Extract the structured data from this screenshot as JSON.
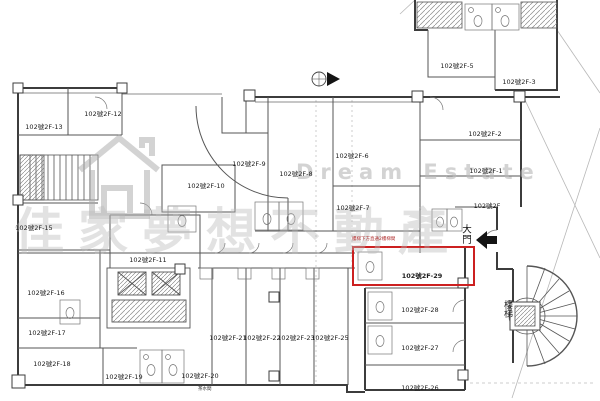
{
  "watermark": {
    "brand_en": "Dream Estate",
    "brand_zh": "佳家夢想不動產"
  },
  "annotations": {
    "entrance_label": "大門",
    "stair_label": "樓梯",
    "red_note": "樓梯下方直通2樓梯間",
    "pantry_label": "茶水間"
  },
  "highlight": {
    "room": "102號2F-29",
    "color": "#cc2020"
  },
  "rooms": [
    {
      "label": "102號2F-13",
      "x": 44,
      "y": 126
    },
    {
      "label": "102號2F-12",
      "x": 103,
      "y": 113
    },
    {
      "label": "102號2F-15",
      "x": 34,
      "y": 227
    },
    {
      "label": "102號2F-16",
      "x": 46,
      "y": 292
    },
    {
      "label": "102號2F-17",
      "x": 47,
      "y": 332
    },
    {
      "label": "102號2F-18",
      "x": 52,
      "y": 363
    },
    {
      "label": "102號2F-11",
      "x": 148,
      "y": 259
    },
    {
      "label": "102號2F-10",
      "x": 206,
      "y": 185
    },
    {
      "label": "102號2F-9",
      "x": 249,
      "y": 163
    },
    {
      "label": "102號2F-8",
      "x": 296,
      "y": 173
    },
    {
      "label": "102號2F-6",
      "x": 352,
      "y": 155
    },
    {
      "label": "102號2F-7",
      "x": 353,
      "y": 207
    },
    {
      "label": "102號2F-5",
      "x": 457,
      "y": 65
    },
    {
      "label": "102號2F-3",
      "x": 519,
      "y": 81
    },
    {
      "label": "102號2F-2",
      "x": 485,
      "y": 133
    },
    {
      "label": "102號2F-1",
      "x": 486,
      "y": 170
    },
    {
      "label": "102號2F",
      "x": 487,
      "y": 205
    },
    {
      "label": "102號2F-19",
      "x": 124,
      "y": 376
    },
    {
      "label": "102號2F-20",
      "x": 200,
      "y": 375
    },
    {
      "label": "102號2F-21",
      "x": 228,
      "y": 337
    },
    {
      "label": "102號2F-22",
      "x": 262,
      "y": 337
    },
    {
      "label": "102號2F-23",
      "x": 296,
      "y": 337
    },
    {
      "label": "102號2F-25",
      "x": 330,
      "y": 337
    },
    {
      "label": "102號2F-29",
      "x": 422,
      "y": 275
    },
    {
      "label": "102號2F-28",
      "x": 420,
      "y": 309
    },
    {
      "label": "102號2F-27",
      "x": 420,
      "y": 347
    },
    {
      "label": "102號2F-26",
      "x": 420,
      "y": 387
    }
  ]
}
